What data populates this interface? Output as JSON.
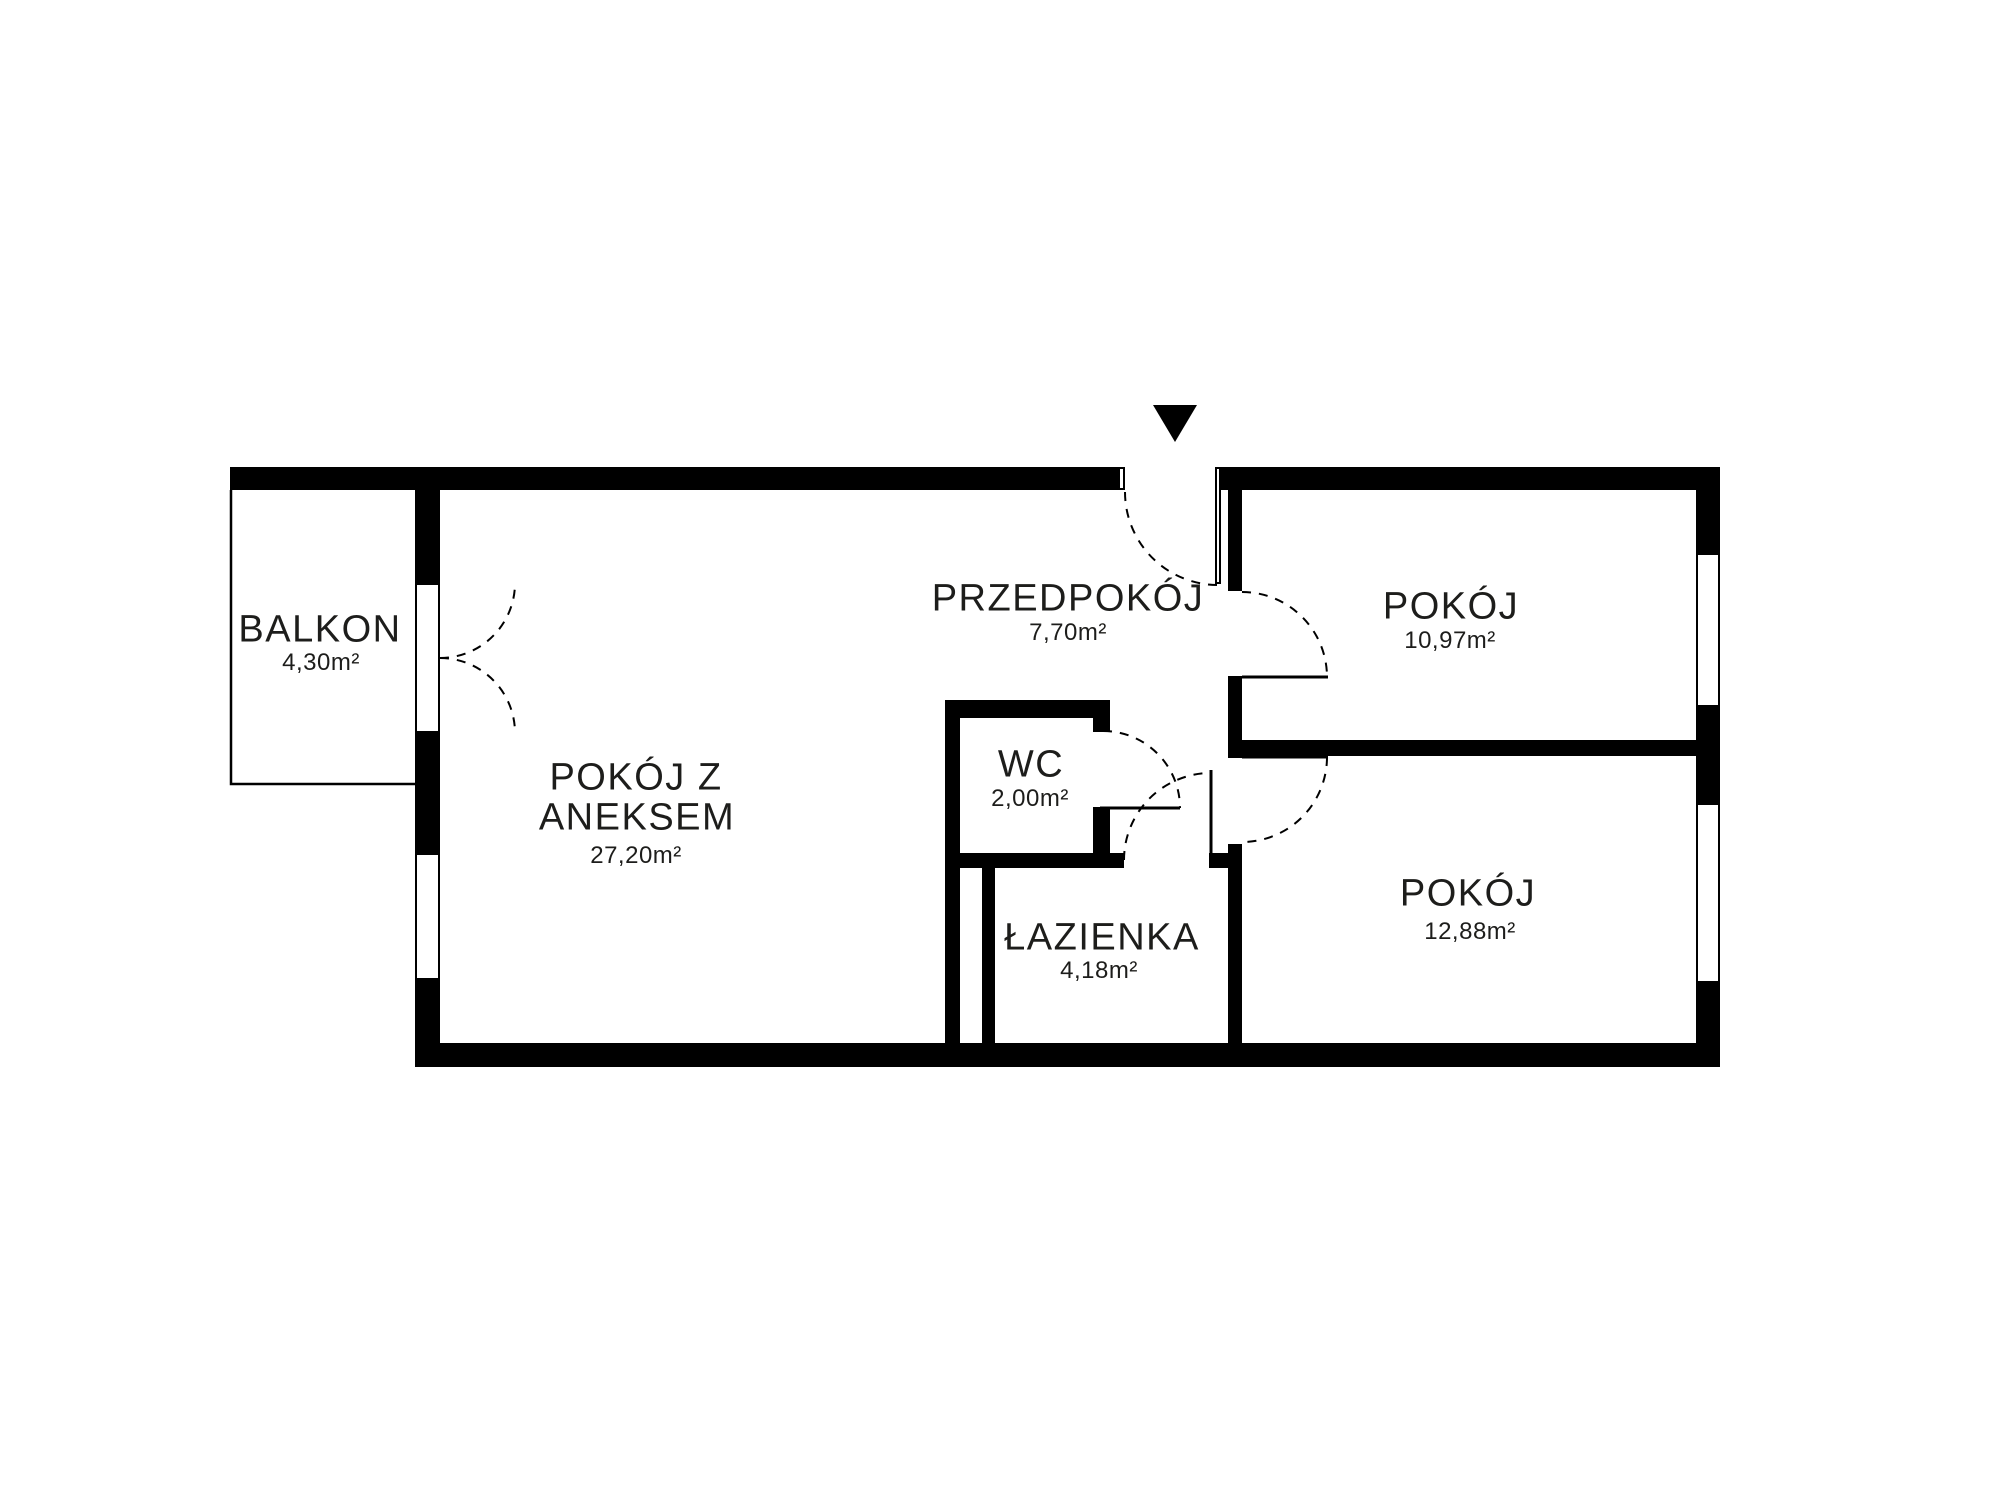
{
  "plan": {
    "colors": {
      "wall": "#000000",
      "background": "#ffffff",
      "text": "#1d1d1b"
    },
    "icons": {
      "entrance_marker": "filled-down-triangle"
    },
    "rooms": {
      "balkon": {
        "label": "BALKON",
        "area": "4,30m²"
      },
      "pokoj_z_aneksem": {
        "label_line1": "POKÓJ Z",
        "label_line2": "ANEKSEM",
        "area": "27,20m²"
      },
      "przedpokoj": {
        "label": "PRZEDPOKÓJ",
        "area": "7,70m²"
      },
      "wc": {
        "label": "WC",
        "area": "2,00m²"
      },
      "lazienka": {
        "label": "ŁAZIENKA",
        "area": "4,18m²"
      },
      "pokoj_gorny": {
        "label": "POKÓJ",
        "area": "10,97m²"
      },
      "pokoj_dolny": {
        "label": "POKÓJ",
        "area": "12,88m²"
      }
    }
  }
}
